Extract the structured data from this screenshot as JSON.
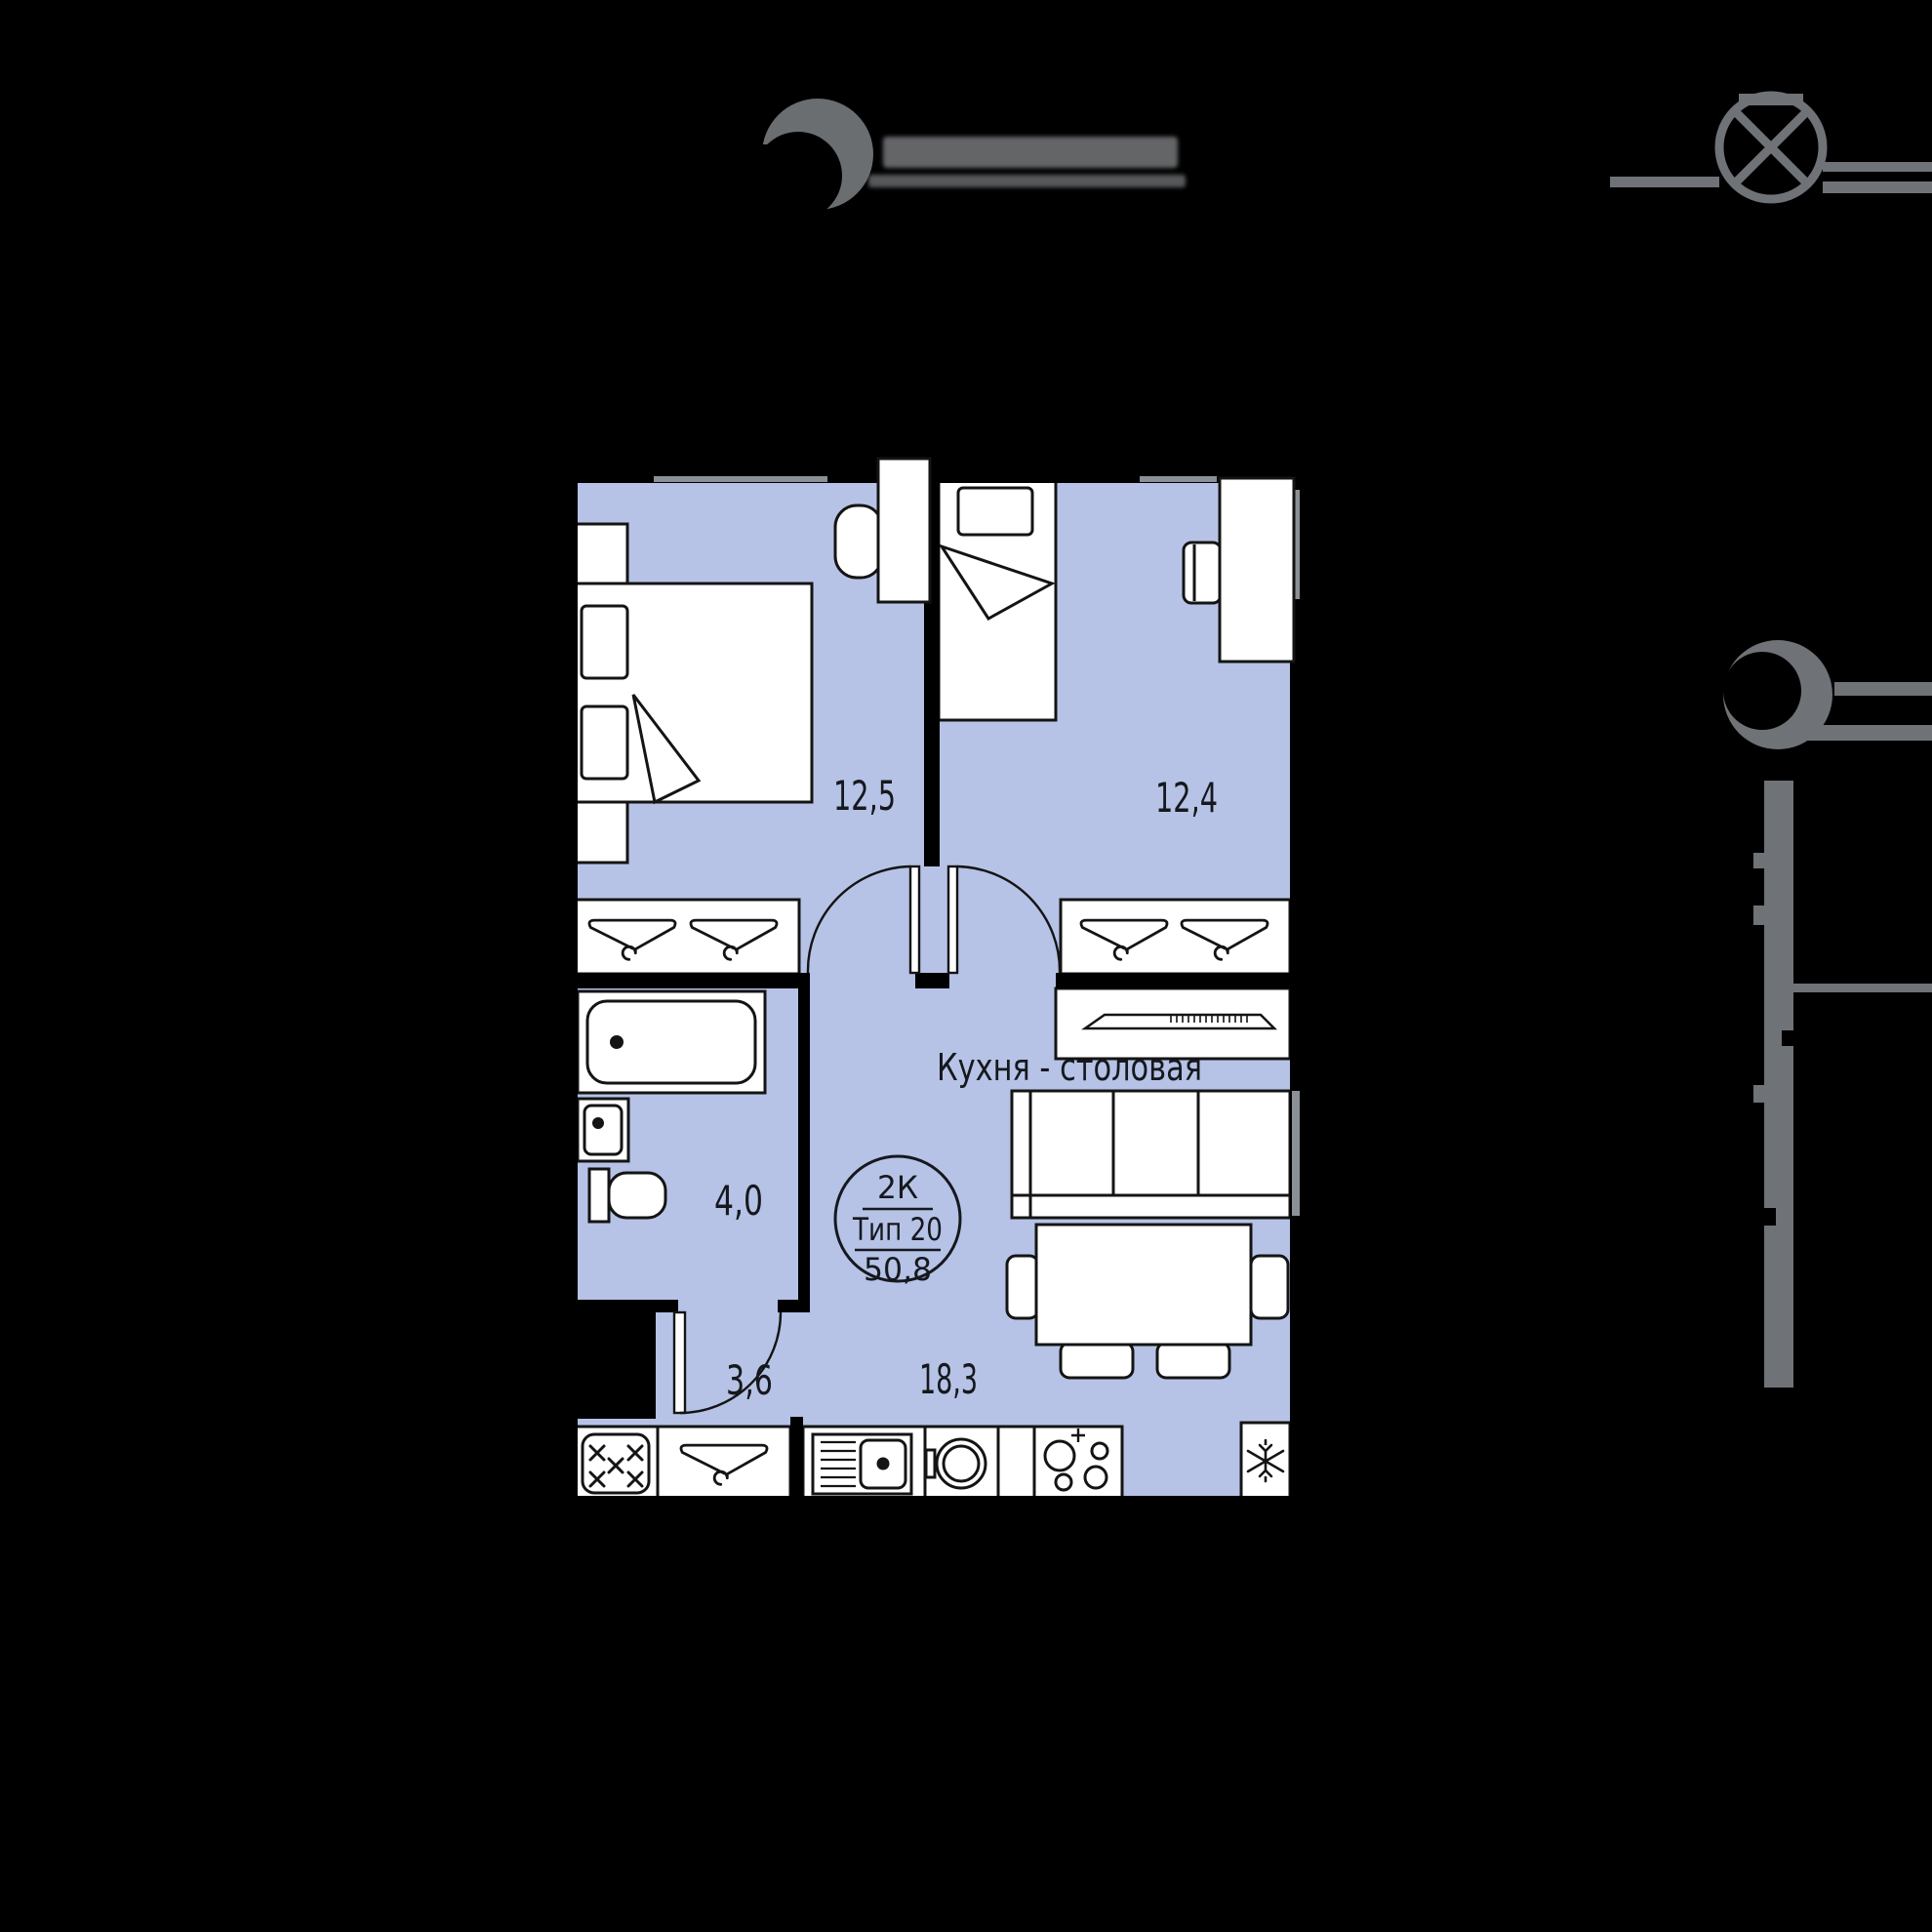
{
  "header": {
    "brand_logo_icon": "crescent-circle-icon",
    "brand_color": "#6b6e70",
    "compass_icon": "compass-cross-icon"
  },
  "sidebar_indicator": {
    "icon": "crescent-circle-icon",
    "color": "#6f7276"
  },
  "plan": {
    "colors": {
      "floor": "#b6c3e6",
      "wall": "#000000",
      "furniture": "#ffffff",
      "line": "#141414",
      "window": "#8a9096",
      "label": "#15181d"
    },
    "badge": {
      "rooms_label": "2К",
      "type_label": "Тип 20",
      "area_label": "50,8"
    },
    "rooms": [
      {
        "id": "bedroom-1",
        "area": "12,5"
      },
      {
        "id": "bedroom-2",
        "area": "12,4"
      },
      {
        "id": "bathroom",
        "area": "4,0"
      },
      {
        "id": "hallway",
        "area": "3,6"
      },
      {
        "id": "kitchen-dining",
        "name": "Кухня - столовая",
        "area": "18,3"
      }
    ]
  }
}
